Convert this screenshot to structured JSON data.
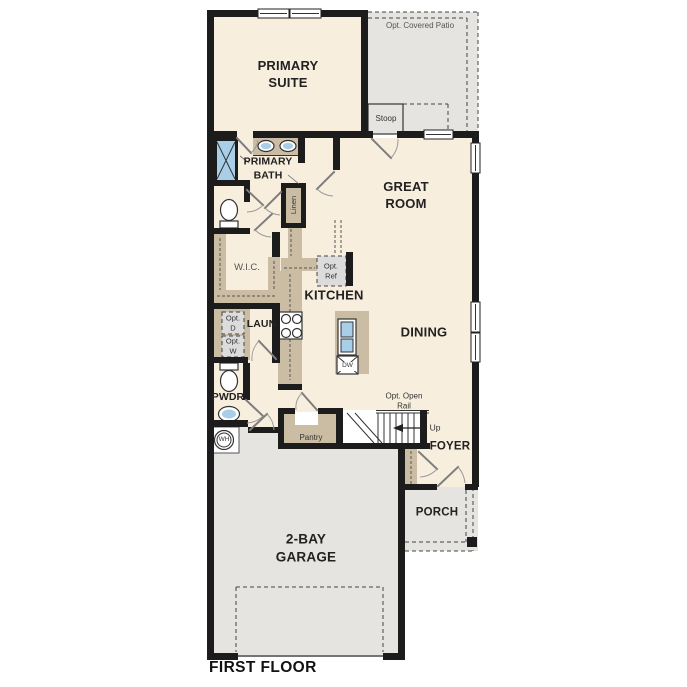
{
  "floor_title": "FIRST FLOOR",
  "rooms": {
    "primary_suite": "PRIMARY SUITE",
    "primary_bath": "PRIMARY BATH",
    "great_room": "GREAT ROOM",
    "kitchen": "KITCHEN",
    "dining": "DINING",
    "walk_in_closet": "W.I.C.",
    "laundry": "LAUN.",
    "powder": "PWDR",
    "pantry": "Pantry",
    "linen": "Linen",
    "foyer": "FOYER",
    "porch": "PORCH",
    "garage": "2-BAY GARAGE",
    "stoop": "Stoop",
    "covered_patio": "Opt. Covered Patio"
  },
  "annotations": {
    "opt_ref": "Opt. Ref",
    "opt_dryer": "Opt. D",
    "opt_washer": "Opt. W",
    "opt_open_rail": "Opt. Open Rail",
    "up": "Up",
    "water_heater": "WH",
    "dishwasher": "DW"
  },
  "colors": {
    "floor_cream": "#f7eede",
    "exterior_gray": "#e5e4e0",
    "cabinet_tan": "#cbbda4",
    "fixture_blue": "#a9cee8",
    "wall_black": "#1c1c1c",
    "optional_gray": "#dcdcdc"
  }
}
